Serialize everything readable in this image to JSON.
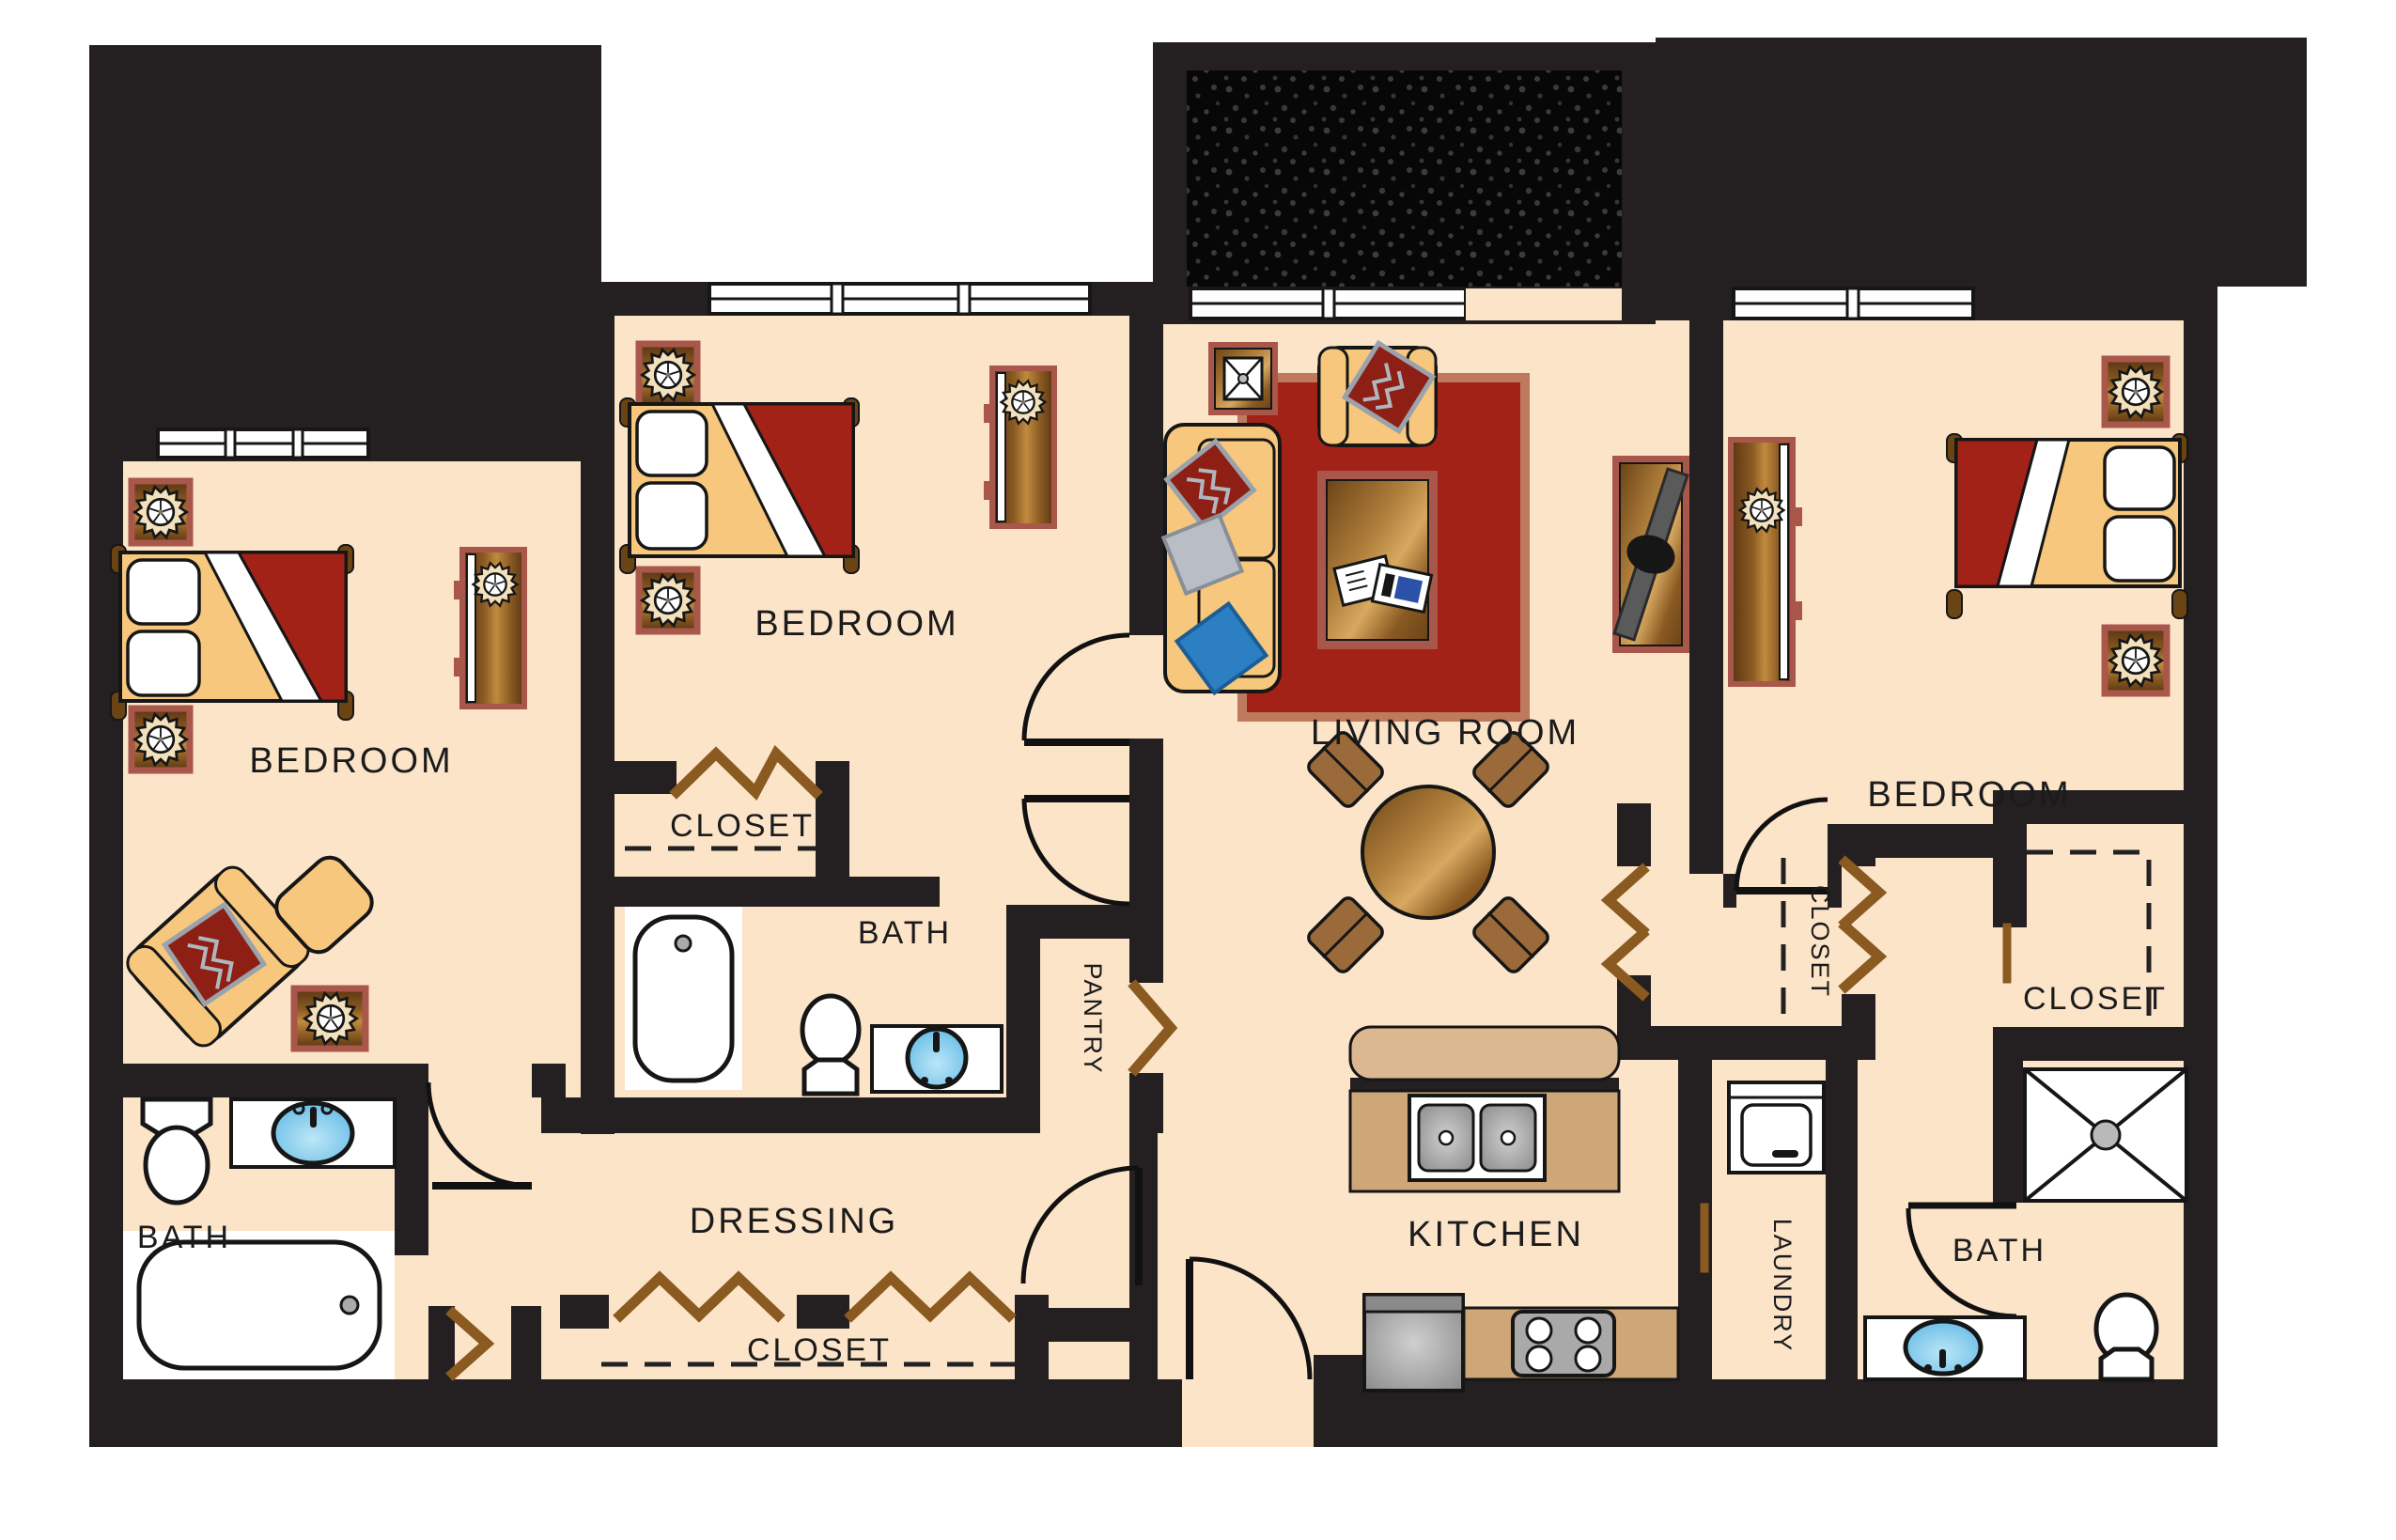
{
  "title": "Apartment floor plan",
  "rooms": [
    {
      "id": "bedroom-left",
      "label": "BEDROOM"
    },
    {
      "id": "bedroom-middle",
      "label": "BEDROOM"
    },
    {
      "id": "living-room",
      "label": "LIVING ROOM"
    },
    {
      "id": "bedroom-right",
      "label": "BEDROOM"
    },
    {
      "id": "closet-middle",
      "label": "CLOSET"
    },
    {
      "id": "bath-middle",
      "label": "BATH"
    },
    {
      "id": "pantry",
      "label": "PANTRY"
    },
    {
      "id": "bath-left",
      "label": "BATH"
    },
    {
      "id": "dressing",
      "label": "DRESSING"
    },
    {
      "id": "closet-dressing",
      "label": "CLOSET"
    },
    {
      "id": "kitchen",
      "label": "KITCHEN"
    },
    {
      "id": "laundry",
      "label": "LAUNDRY"
    },
    {
      "id": "closet-hall",
      "label": "CLOSET"
    },
    {
      "id": "closet-right",
      "label": "CLOSET"
    },
    {
      "id": "bath-right",
      "label": "BATH"
    }
  ],
  "colors": {
    "floor": "#fce4c9",
    "wall": "#241f20",
    "bed_red": "#a32218",
    "rug_red": "#a32218",
    "rug_border": "#bf7a5e",
    "trim_rose": "#a8574a",
    "tan_furniture": "#f6c77c",
    "counter_tan": "#cfa678",
    "counter_lip": "#dcb890",
    "sink_blue": "#7ec8ec",
    "appliance_gray": "#9a9a9a",
    "door_wood": "#8a5a20",
    "pillow_blue": "#2b7fc2",
    "pillow_gray": "#b9bec6",
    "pillow_red": "#8e1f14"
  },
  "legend": {
    "beds": 3,
    "nightstand_lamps": 6,
    "dressers": 3,
    "bathtubs": 2,
    "showers": 1,
    "toilets": 3,
    "vanity_sinks": 4,
    "dining_seats": 4,
    "kitchen_sink_basins": 2,
    "stove_burners": 4,
    "windows": 4
  }
}
